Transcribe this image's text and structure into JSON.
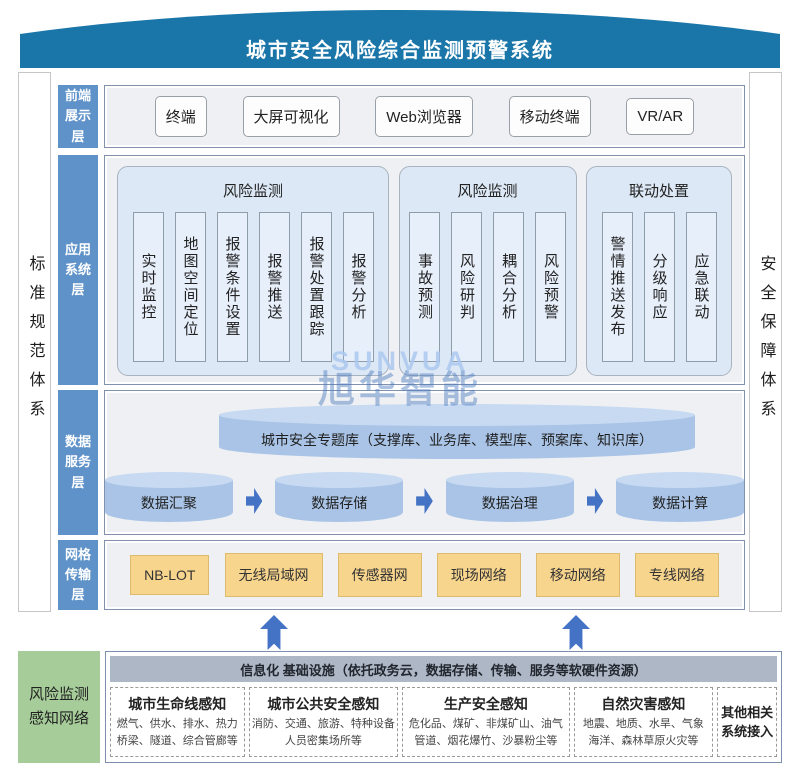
{
  "banner": {
    "title": "城市安全风险综合监测预警系统"
  },
  "sidebars": {
    "left": "标准规范体系",
    "right": "安全保障体系"
  },
  "layer_labels": [
    "前端展示层",
    "应用系统层",
    "数据服务层",
    "网格传输层"
  ],
  "frontend": {
    "items": [
      "终端",
      "大屏可视化",
      "Web浏览器",
      "移动终端",
      "VR/AR"
    ]
  },
  "application": {
    "groups": [
      {
        "title": "风险监测",
        "items": [
          "实时监控",
          "地图空间定位",
          "报警条件设置",
          "报警推送",
          "报警处置跟踪",
          "报警分析"
        ]
      },
      {
        "title": "风险监测",
        "items": [
          "事故预测",
          "风险研判",
          "耦合分析",
          "风险预警"
        ]
      },
      {
        "title": "联动处置",
        "items": [
          "警情推送发布",
          "分级响应",
          "应急联动"
        ]
      }
    ]
  },
  "data_service": {
    "database": "城市安全专题库（支撑库、业务库、模型库、预案库、知识库）",
    "pipeline": [
      "数据汇聚",
      "数据存储",
      "数据治理",
      "数据计算"
    ]
  },
  "network": {
    "items": [
      "NB-LOT",
      "无线局域网",
      "传感器网",
      "现场网络",
      "移动网络",
      "专线网络"
    ]
  },
  "perception": {
    "label": "风险监测感知网络",
    "infra_header": "信息化 基础设施（依托政务云，数据存储、传输、服务等软硬件资源）",
    "boxes": [
      {
        "title": "城市生命线感知",
        "line1": "燃气、供水、排水、热力",
        "line2": "桥梁、隧道、综合管廊等"
      },
      {
        "title": "城市公共安全感知",
        "line1": "消防、交通、旅游、特种设备",
        "line2": "人员密集场所等"
      },
      {
        "title": "生产安全感知",
        "line1": "危化品、煤矿、非煤矿山、油气",
        "line2": "管道、烟花爆竹、沙暴粉尘等"
      },
      {
        "title": "自然灾害感知",
        "line1": "地震、地质、水旱、气象",
        "line2": "海洋、森林草原火灾等"
      },
      {
        "title": "其他相关系统接入",
        "line1": "",
        "line2": ""
      }
    ]
  },
  "watermark": {
    "latin": "SUNVUA",
    "cjk": "旭华智能"
  },
  "colors": {
    "banner": "#1a76a9",
    "layer_label": "#5e92c8",
    "cylinder_body": "#a9c4e6",
    "cylinder_top": "#c7daf2",
    "arrow": "#4472c4",
    "network_box": "#f8d58d",
    "green_box": "#a6cd99",
    "infra_header_bg": "#aeb7c6"
  }
}
